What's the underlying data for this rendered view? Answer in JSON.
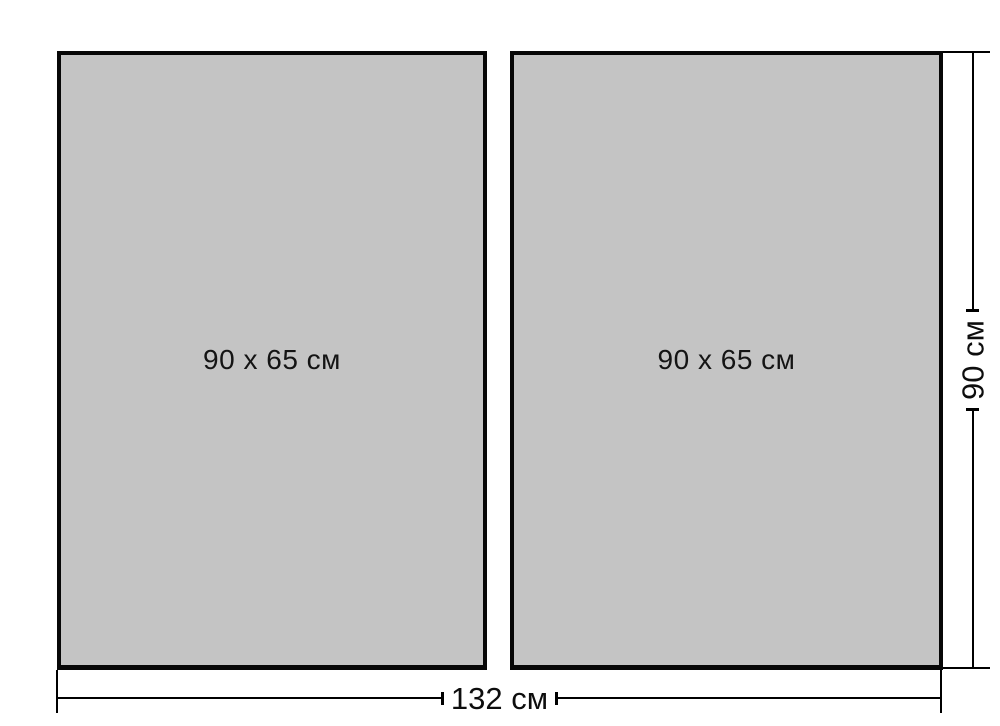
{
  "panels": [
    {
      "label": "90 x 65 см"
    },
    {
      "label": "90 x 65 см"
    }
  ],
  "dimensions": {
    "total_width_label": "132 см",
    "total_height_label": "90 см"
  },
  "colors": {
    "background": "#ffffff",
    "panel_fill": "#c4c4c4",
    "panel_border": "#070707",
    "dimension_line": "#000000",
    "label_text": "#0d0d0d"
  }
}
